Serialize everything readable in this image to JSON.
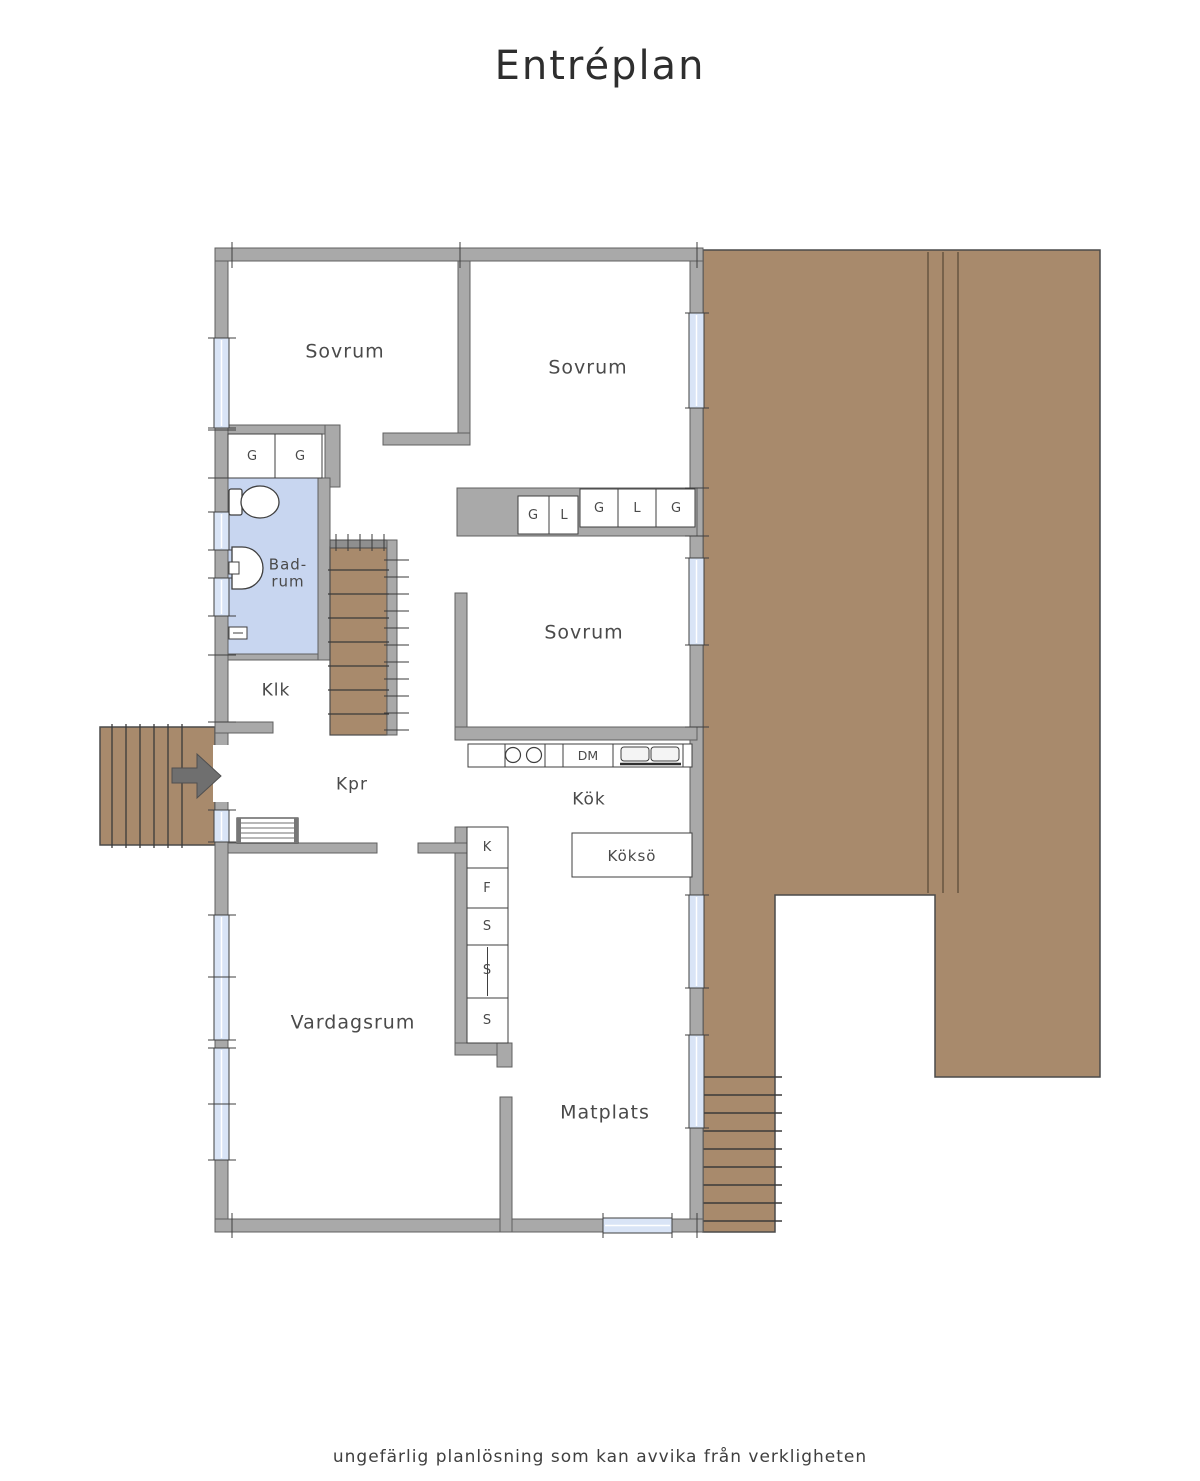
{
  "title": "Entréplan",
  "footer": "ungefärlig planlösning som kan avvika från verkligheten",
  "rooms": {
    "sovrum1": "Sovrum",
    "sovrum2": "Sovrum",
    "sovrum3": "Sovrum",
    "badrum": "Bad-\nrum",
    "klk": "Klk",
    "kpr": "Kpr",
    "kok": "Kök",
    "kokso": "Köksö",
    "vardagsrum": "Vardagsrum",
    "matplats": "Matplats"
  },
  "wardrobes": {
    "bed1": [
      "G",
      "G"
    ],
    "hall_row": [
      "G",
      "L",
      "G",
      "L",
      "G"
    ],
    "tall_units": [
      "K",
      "F",
      "S",
      "S",
      "S"
    ]
  },
  "appliances": {
    "dishwasher": "DM"
  },
  "colors": {
    "wall": "#a9a9a9",
    "deck": "#a88a6c",
    "bathroom_floor": "#c8d6f0",
    "window": "#d9e4f6",
    "outline": "#3f3f3f",
    "text": "#4a4a4a"
  }
}
